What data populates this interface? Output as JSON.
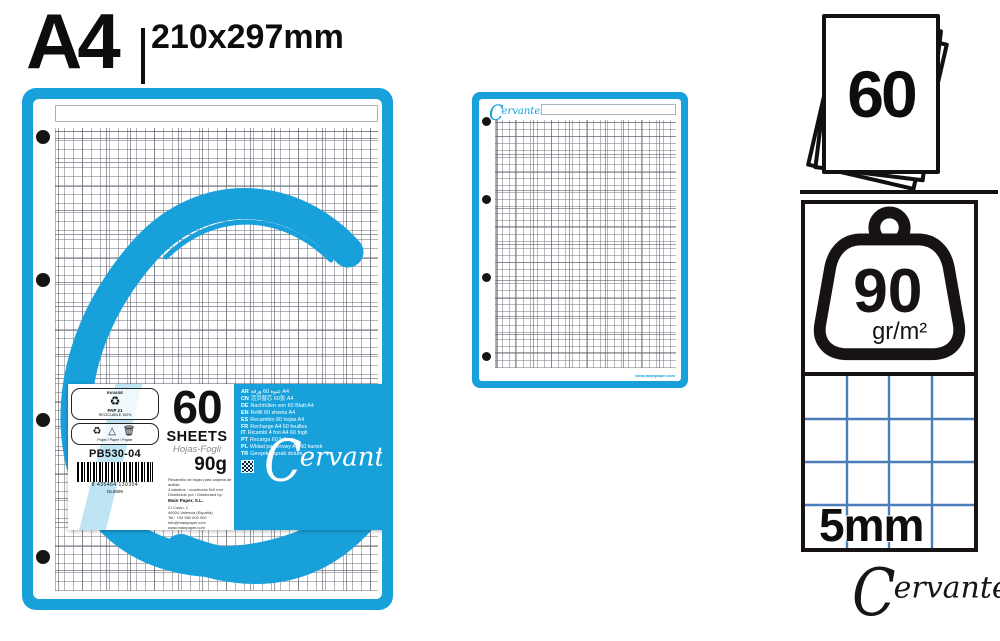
{
  "header": {
    "format": "A4",
    "size": "210x297mm"
  },
  "brand": {
    "name_c": "C",
    "name_rest": "ervantes",
    "registered": "®",
    "blue": "#18A0DB",
    "grid_blue": "#4A7EBB"
  },
  "label": {
    "count": "60",
    "count_word": "SHEETS",
    "count_translations": "Hojas-Fogli",
    "weight": "90g",
    "product_code": "PB530-04",
    "barcode_number": "8 435464 130304",
    "batch": "DL0909",
    "eco_box1": {
      "header": "ENVASE",
      "symbol": "♻",
      "code": "PAP 21",
      "caption": "RECICLABLE 100%"
    },
    "eco_box2": {
      "icons": "♻ △ 🗑",
      "caption": "Papel / Paper / Papier"
    },
    "fineprint": "Recambio de hojas para carpeta de anillas\n4 taladros · cuadrícula 5x5 mm\nDistribuido por / Distributed by:",
    "maker": "Main Paper, S.L.",
    "address": "C/ Colón, 1\n46004 Valencia (España)\nTel.: +34 960 000 000\ninfo@mainpaper.com\nwww.mainpaper.com",
    "languages": [
      {
        "code": "AR",
        "text": "عبوة 60 ورقة A4"
      },
      {
        "code": "CN",
        "text": "活页替芯 60张 A4"
      },
      {
        "code": "DE",
        "text": "Nachfüllen von 60 Blatt A4"
      },
      {
        "code": "EN",
        "text": "Refill 60 sheets A4"
      },
      {
        "code": "ES",
        "text": "Recambio 60 hojas A4"
      },
      {
        "code": "FR",
        "text": "Recharge A4 60 feuilles"
      },
      {
        "code": "IT",
        "text": "Ricambi 4 fori A4 60 fogli"
      },
      {
        "code": "PT",
        "text": "Recarga 60 folhas"
      },
      {
        "code": "PL",
        "text": "Wkład papierowy A4 60 kartek"
      },
      {
        "code": "TR",
        "text": "Gevşek yaprak dolum"
      }
    ]
  },
  "small_sheet": {
    "url": "www.mainpaper.com"
  },
  "specs": {
    "sheet_count": "60",
    "weight_value": "90",
    "weight_unit": "gr/m²",
    "grid_size": "5mm"
  }
}
